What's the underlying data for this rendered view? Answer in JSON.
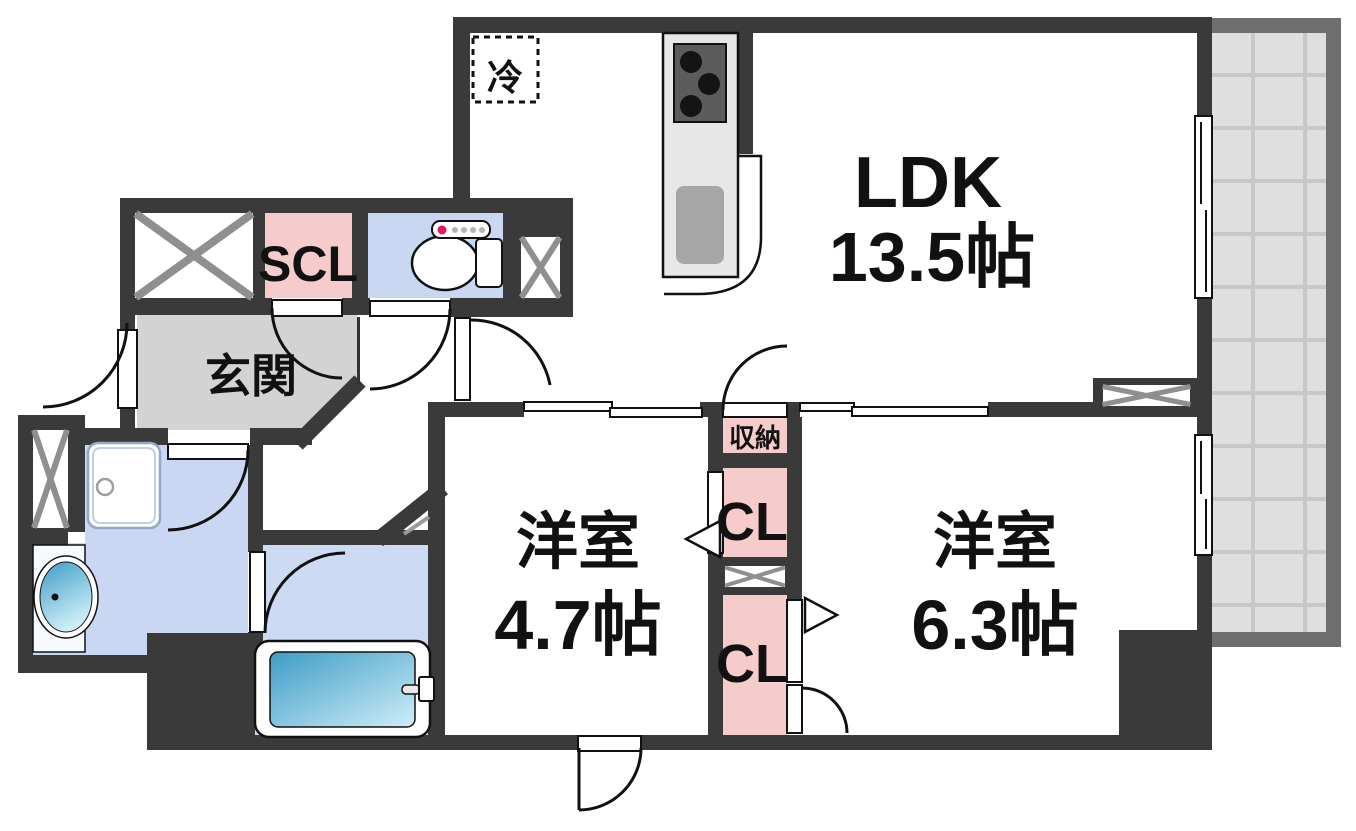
{
  "floorplan": {
    "labels": {
      "ldk_name": "LDK",
      "ldk_size": "13.5帖",
      "room1_name": "洋室",
      "room1_size": "4.7帖",
      "room2_name": "洋室",
      "room2_size": "6.3帖",
      "entrance": "玄関",
      "shoe_closet": "SCL",
      "storage": "収納",
      "closet1": "CL",
      "closet2": "CL",
      "refrigerator": "冷"
    },
    "colors": {
      "wall": "#3a3a3a",
      "closet_pink": "#f6cbcb",
      "wet_area_blue": "#c9d7f2",
      "entrance_gray": "#d3d3d3",
      "balcony_floor": "#dfdfdf",
      "balcony_frame": "#6e6e6e",
      "hatch_gray": "#8f8f8f",
      "tub_water": "#3e9cc6",
      "toilet_button_red": "#e3175e"
    }
  }
}
